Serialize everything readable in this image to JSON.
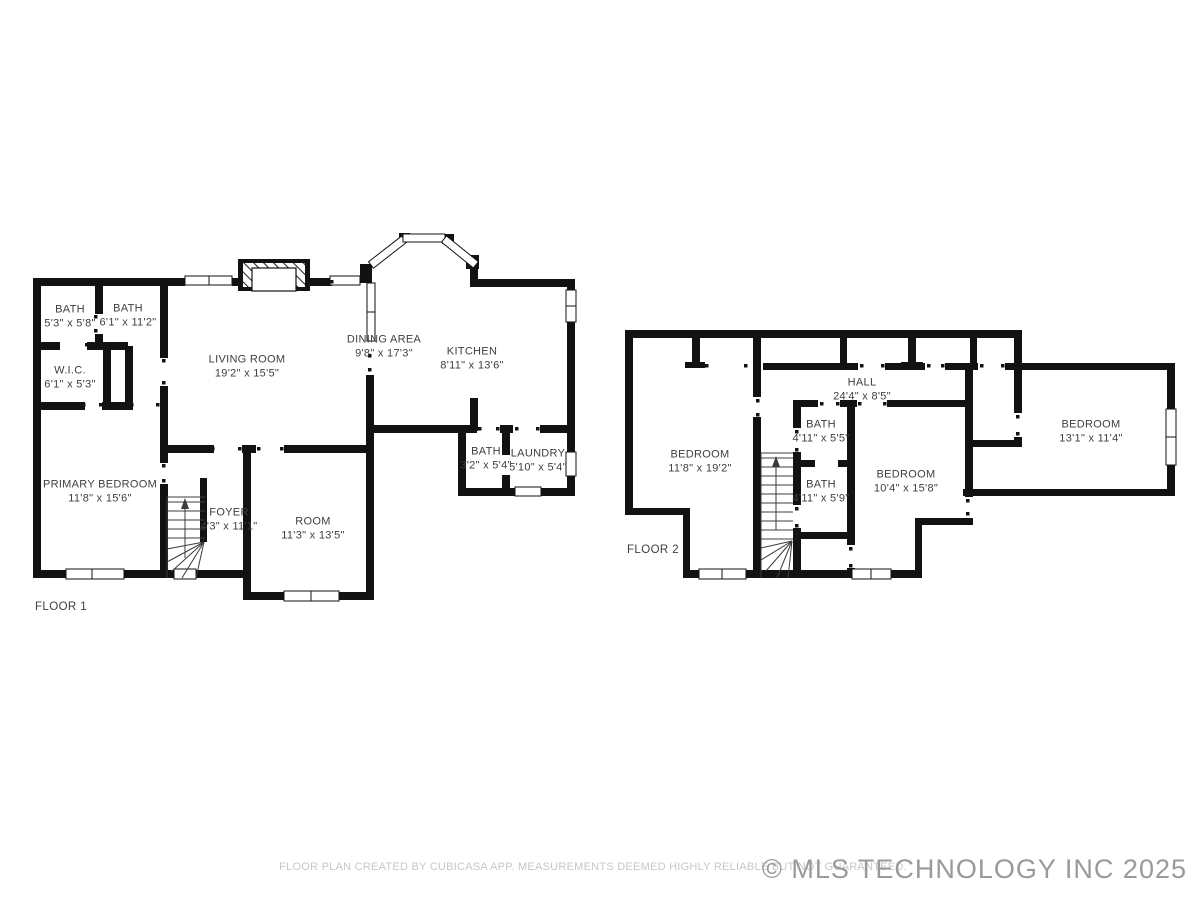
{
  "colors": {
    "wall": "#121212",
    "label": "#3e3e3e",
    "disclaimer": "#c7c7c7",
    "copyright": "#9a9a9a"
  },
  "meta": {
    "disclaimer": "FLOOR PLAN CREATED BY CUBICASA APP. MEASUREMENTS DEEMED HIGHLY RELIABLE BUT NOT GUARANTEED.",
    "copyright": "© MLS TECHNOLOGY INC 2025"
  },
  "floor1": {
    "title": "FLOOR 1",
    "rooms": [
      {
        "name": "BATH",
        "dims": "5'3\" x 5'8\""
      },
      {
        "name": "BATH",
        "dims": "6'1\" x 11'2\""
      },
      {
        "name": "W.I.C.",
        "dims": "6'1\" x 5'3\""
      },
      {
        "name": "LIVING ROOM",
        "dims": "19'2\" x 15'5\""
      },
      {
        "name": "DINING AREA",
        "dims": "9'8\" x 17'3\""
      },
      {
        "name": "KITCHEN",
        "dims": "8'11\" x 13'6\""
      },
      {
        "name": "BATH",
        "dims": "3'2\" x 5'4\""
      },
      {
        "name": "LAUNDRY",
        "dims": "5'10\" x 5'4\""
      },
      {
        "name": "PRIMARY BEDROOM",
        "dims": "11'8\" x 15'6\""
      },
      {
        "name": "FOYER",
        "dims": "4'3\" x 11'1\""
      },
      {
        "name": "ROOM",
        "dims": "11'3\" x 13'5\""
      }
    ]
  },
  "floor2": {
    "title": "FLOOR 2",
    "rooms": [
      {
        "name": "BEDROOM",
        "dims": "11'8\" x 19'2\""
      },
      {
        "name": "HALL",
        "dims": "24'4\" x 8'5\""
      },
      {
        "name": "BATH",
        "dims": "4'11\" x 5'5\""
      },
      {
        "name": "BATH",
        "dims": "4'11\" x 5'9\""
      },
      {
        "name": "BEDROOM",
        "dims": "10'4\" x 15'8\""
      },
      {
        "name": "BEDROOM",
        "dims": "13'1\" x 11'4\""
      }
    ]
  }
}
